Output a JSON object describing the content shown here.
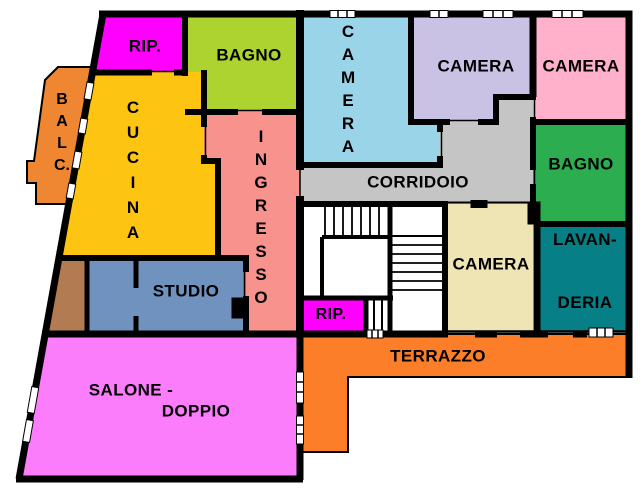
{
  "plan_title": "apartment-floor-plan",
  "wall_color": "#000000",
  "background_color": "#FFFFFF",
  "rooms": {
    "rip1": {
      "label": "RIP.",
      "color": "#FF00FF"
    },
    "bagno_top": {
      "label": "BAGNO",
      "color": "#ACD32F"
    },
    "cucina": {
      "label": "CUCINA",
      "color": "#FDC511"
    },
    "balcone": {
      "label": "BALC.",
      "color": "#EE8632"
    },
    "ingresso": {
      "label": "INGRESSO",
      "color": "#F7928D"
    },
    "camera_nord": {
      "label": "CAMERA",
      "color": "#9AD4E8"
    },
    "camera_centro": {
      "label": "CAMERA",
      "color": "#C9C2E4"
    },
    "camera_est": {
      "label": "CAMERA",
      "color": "#FFB0CA"
    },
    "bagno_est": {
      "label": "BAGNO",
      "color": "#2CAE50"
    },
    "corridoio": {
      "label": "CORRIDOIO",
      "color": "#C5C5C5"
    },
    "camera_sud": {
      "label": "CAMERA",
      "color": "#EEE4B4"
    },
    "lavanderia": {
      "line1": "LAVAN-",
      "line2": "DERIA",
      "color": "#067F86"
    },
    "rip2": {
      "label": "RIP.",
      "color": "#FF00FF"
    },
    "terrazzo": {
      "label": "TERRAZZO",
      "color": "#FC7E28"
    },
    "studio": {
      "label": "STUDIO",
      "color": "#7092BE"
    },
    "salone": {
      "line1": "SALONE -",
      "line2": "DOPPIO",
      "color": "#FB7DFB"
    },
    "vano_brown": {
      "label": "",
      "color": "#B27B52"
    },
    "scala": {
      "label": "",
      "color": "#FFFFFF"
    }
  }
}
